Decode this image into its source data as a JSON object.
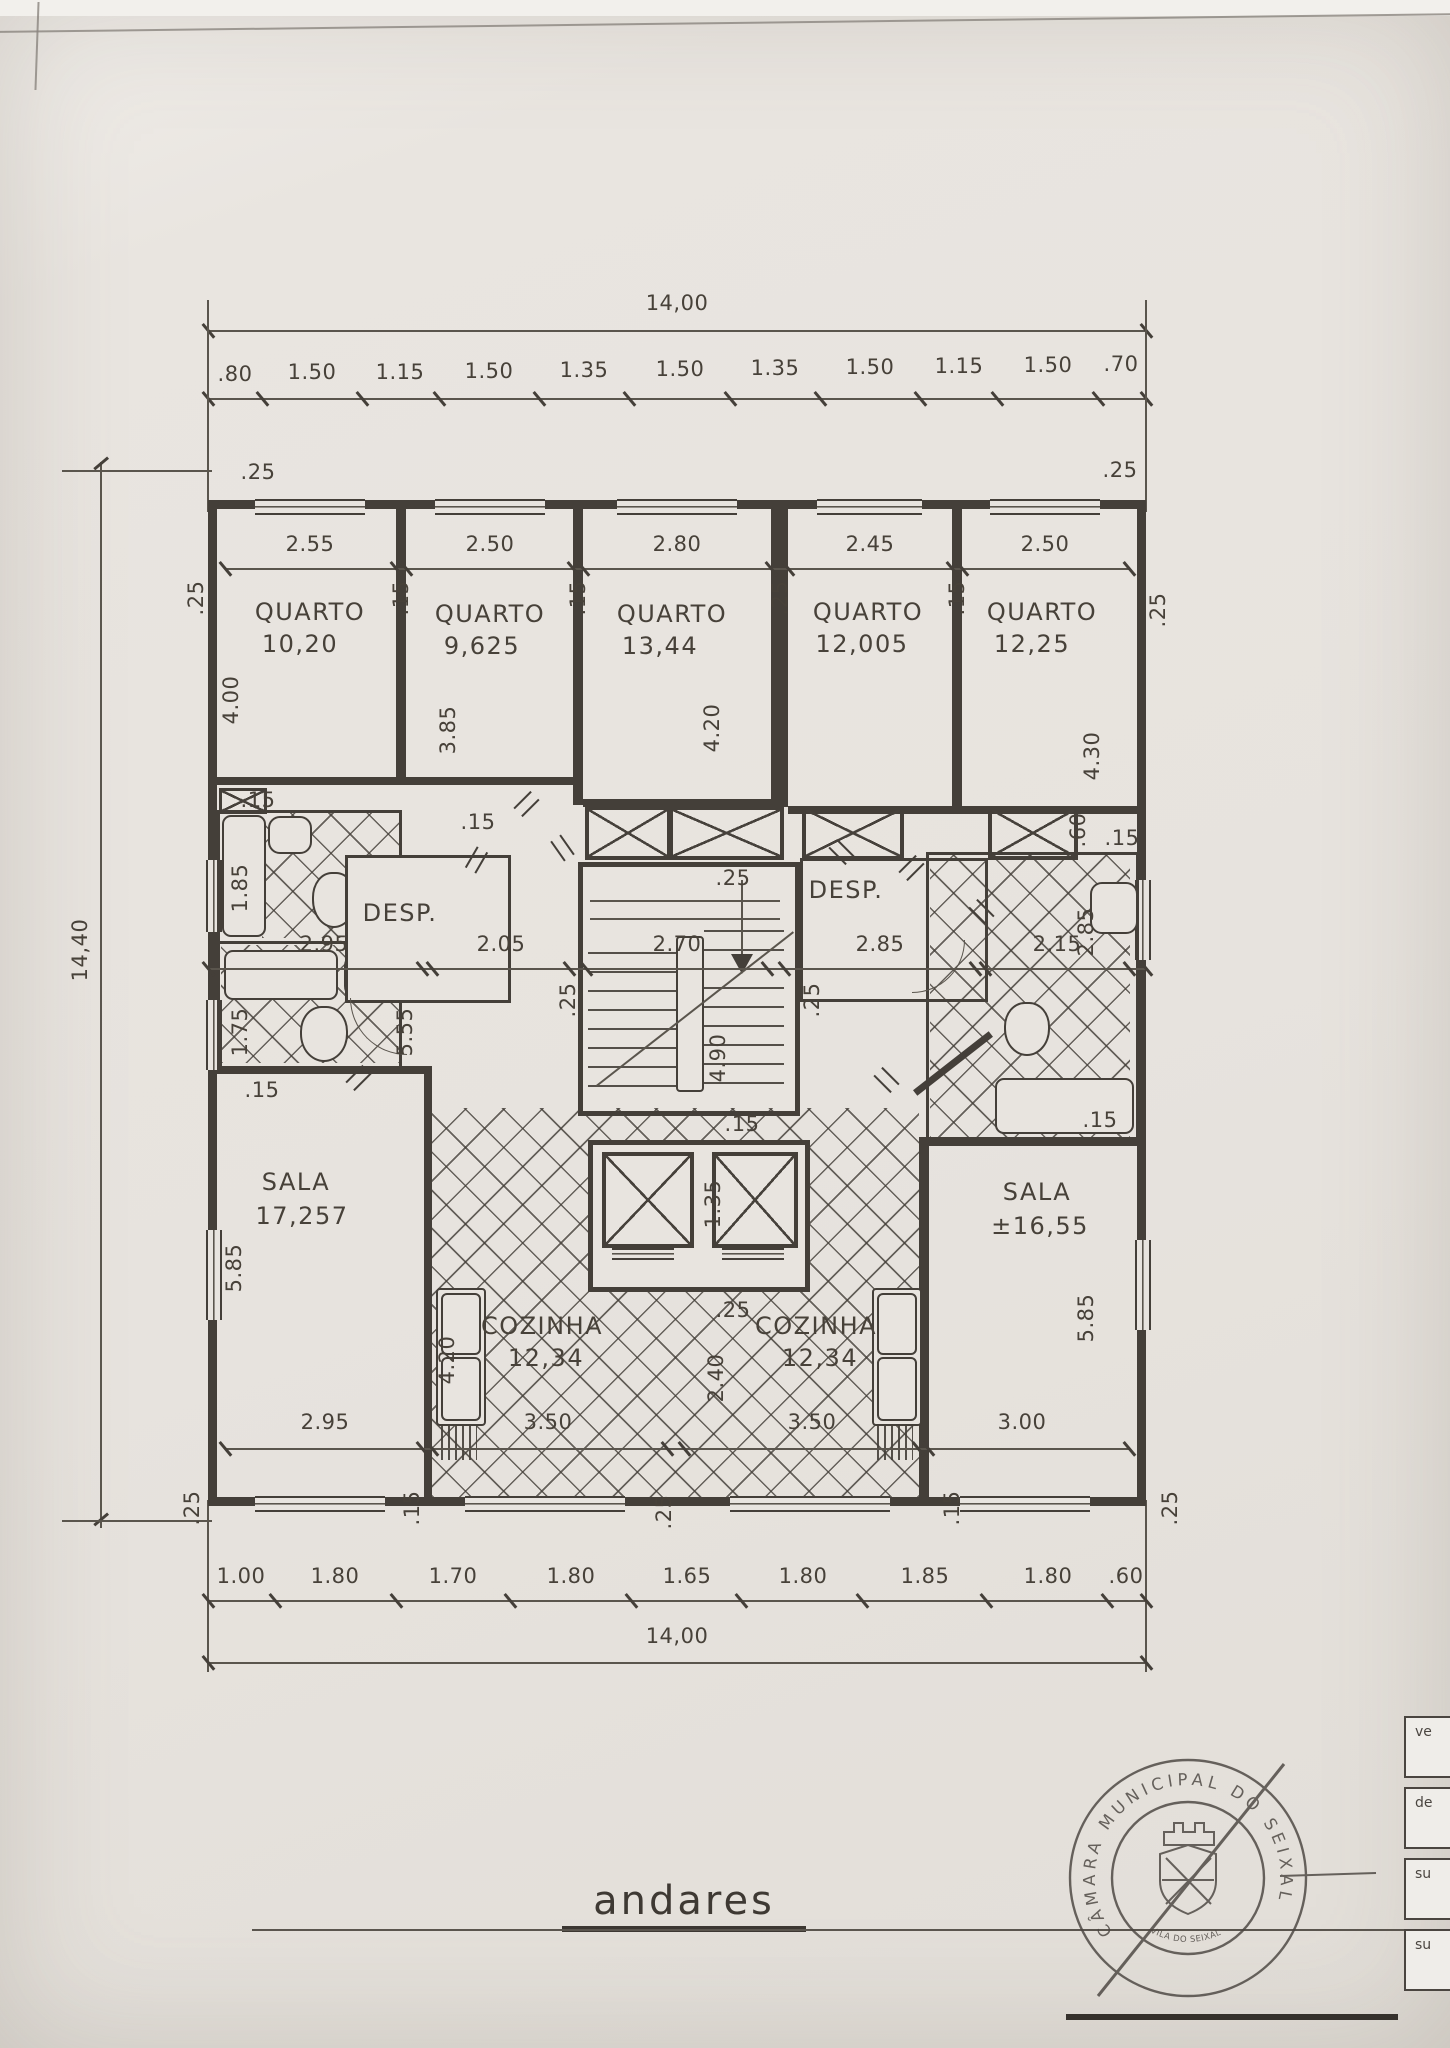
{
  "page": {
    "title": "andares"
  },
  "dims": {
    "top_total": "14,00",
    "bottom_total": "14,00",
    "left_total": "14,40",
    "top_chain": [
      ".80",
      "1.50",
      "1.15",
      "1.50",
      "1.35",
      "1.50",
      "1.35",
      "1.50",
      "1.15",
      "1.50",
      ".70"
    ],
    "bottom_chain": [
      "1.00",
      "1.80",
      "1.70",
      "1.80",
      "1.65",
      "1.80",
      "1.85",
      "1.80",
      ".60"
    ],
    "room_widths": [
      "2.55",
      "2.50",
      "2.80",
      "2.45",
      "2.50"
    ],
    "mid_widths": [
      "2.95",
      "2.05",
      "2.70",
      "2.85",
      "2.15"
    ],
    "bottom_widths": [
      "2.95",
      "3.50",
      "3.50",
      "3.00"
    ],
    "w25": ".25",
    "w15": ".15",
    "w60": ".60",
    "q_depths": [
      "4.00",
      "3.85",
      "4.20",
      "4.30"
    ],
    "bath_left": [
      "1.85",
      "1.75"
    ],
    "hall_depth": "5.55",
    "stair_depth": "4.90",
    "bath_right_w": "2.85",
    "sala_depths": [
      "5.85",
      "5.85"
    ],
    "corridor_w": "2.40",
    "lift_w": "1.35",
    "sink_run": "4.20"
  },
  "rooms": {
    "quartos": [
      {
        "label": "QUARTO",
        "area": "10,20"
      },
      {
        "label": "QUARTO",
        "area": "9,625"
      },
      {
        "label": "QUARTO",
        "area": "13,44"
      },
      {
        "label": "QUARTO",
        "area": "12,005"
      },
      {
        "label": "QUARTO",
        "area": "12,25"
      }
    ],
    "sala_left": {
      "label": "SALA",
      "area": "17,257"
    },
    "sala_right": {
      "label": "SALA",
      "area": "±16,55"
    },
    "cozinha_left": {
      "label": "COZINHA",
      "area": "12,34"
    },
    "cozinha_right": {
      "label": "COZINHA",
      "area": "12,34"
    },
    "desp_left": "DESP.",
    "desp_right": "DESP."
  },
  "stamp": {
    "ring_text": "CÂMARA MUNICIPAL DO SEIXAL",
    "banner": "VILA DO SEIXAL"
  },
  "side_form": {
    "labels": [
      "ve",
      "de",
      "su",
      "su"
    ]
  }
}
